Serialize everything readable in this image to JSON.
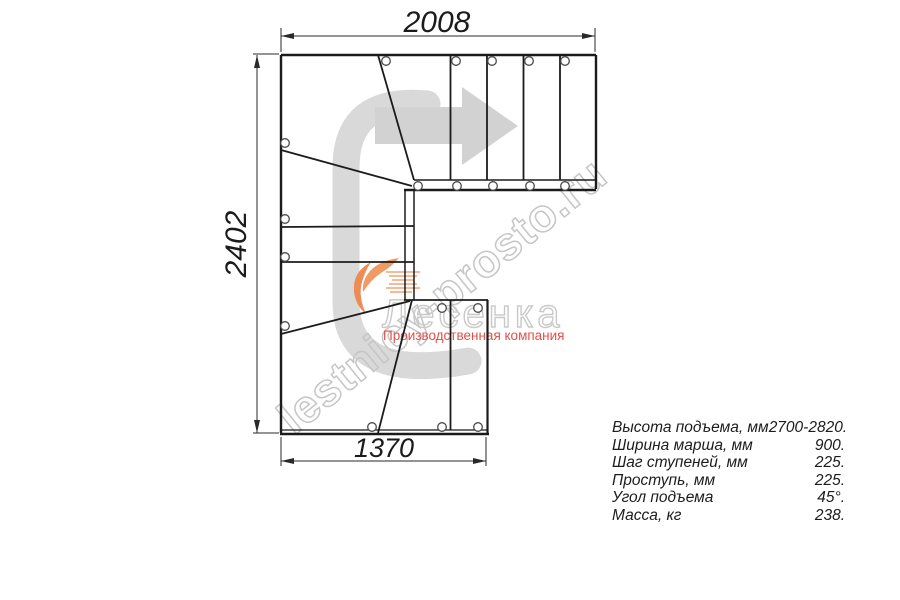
{
  "dimensions": {
    "top": "2008",
    "left": "2402",
    "bottom": "1370"
  },
  "watermark": "lestnicy-prosto.ru",
  "logo": {
    "brand": "Лесенка",
    "tagline": "Производственная компания"
  },
  "specs": {
    "rows": [
      {
        "label": "Высота подъема, мм",
        "value": "2700-2820."
      },
      {
        "label": "Ширина марша, мм",
        "value": "900."
      },
      {
        "label": "Шаг ступеней, мм",
        "value": "225."
      },
      {
        "label": "Проступь, мм",
        "value": "225."
      },
      {
        "label": "Угол подъема",
        "value": "45°."
      },
      {
        "label": "Масса, кг",
        "value": "238."
      }
    ]
  },
  "colors": {
    "line": "#1b1b1b",
    "watermark_gray": "#c6c6c6",
    "shape_gray": "#d9d9d9",
    "arrow_gray": "#d2d2d2",
    "accent_orange": "#ee8c55",
    "tagline_red": "#e25048"
  }
}
